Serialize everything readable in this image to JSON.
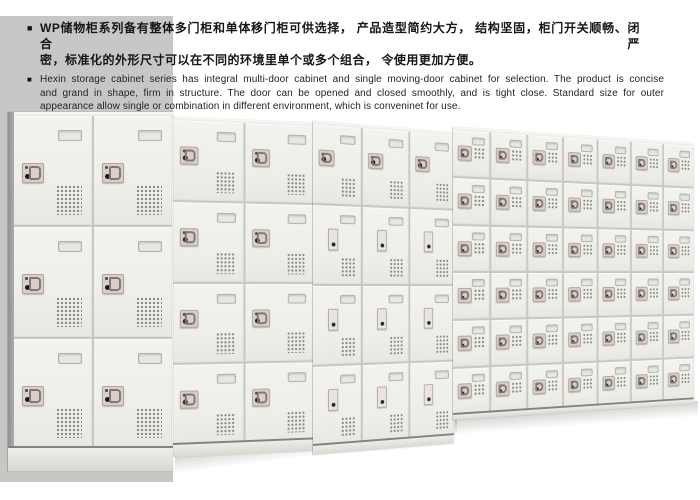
{
  "intro": {
    "zh": {
      "marker": "■",
      "lines": [
        "WP储物柜系列备有整体多门柜和单体移门柜可供选择， 产品造型简约大方， 结构坚固，柜门开关顺畅、闭合严",
        "密，标准化的外形尺寸可以在不同的环境里单个或多个组合， 令使用更加方便。"
      ]
    },
    "en": {
      "marker": "■",
      "lines": [
        "Hexin storage cabinet series has integral multi-door cabinet and single moving-door cabinet for selection. The product is concise",
        "and grand in shape, firm in structure. The door can be opened and closed smoothly, and is tight close. Standard size for outer",
        "appearance allow single or combination in different environment, which is conveninet for use."
      ]
    }
  },
  "photo": {
    "backdrop_color": "#c7c8c6",
    "door_color": "#eff0ea",
    "lock_plate_color": "#d9cec9",
    "cabinets": [
      {
        "id": "cabinet-a-3tier-2door",
        "tiers": 3,
        "columns": 2,
        "lock_style": "hasp"
      },
      {
        "id": "cabinet-b-4tier-2door",
        "tiers": 4,
        "columns": 2,
        "lock_style": "hasp"
      },
      {
        "id": "cabinet-c-4tier-3door",
        "tiers": 4,
        "columns": 3,
        "lock_style": "key"
      },
      {
        "id": "cabinet-d-6tier-7door",
        "tiers": 6,
        "columns": 7,
        "lock_style": "hasp"
      }
    ]
  }
}
